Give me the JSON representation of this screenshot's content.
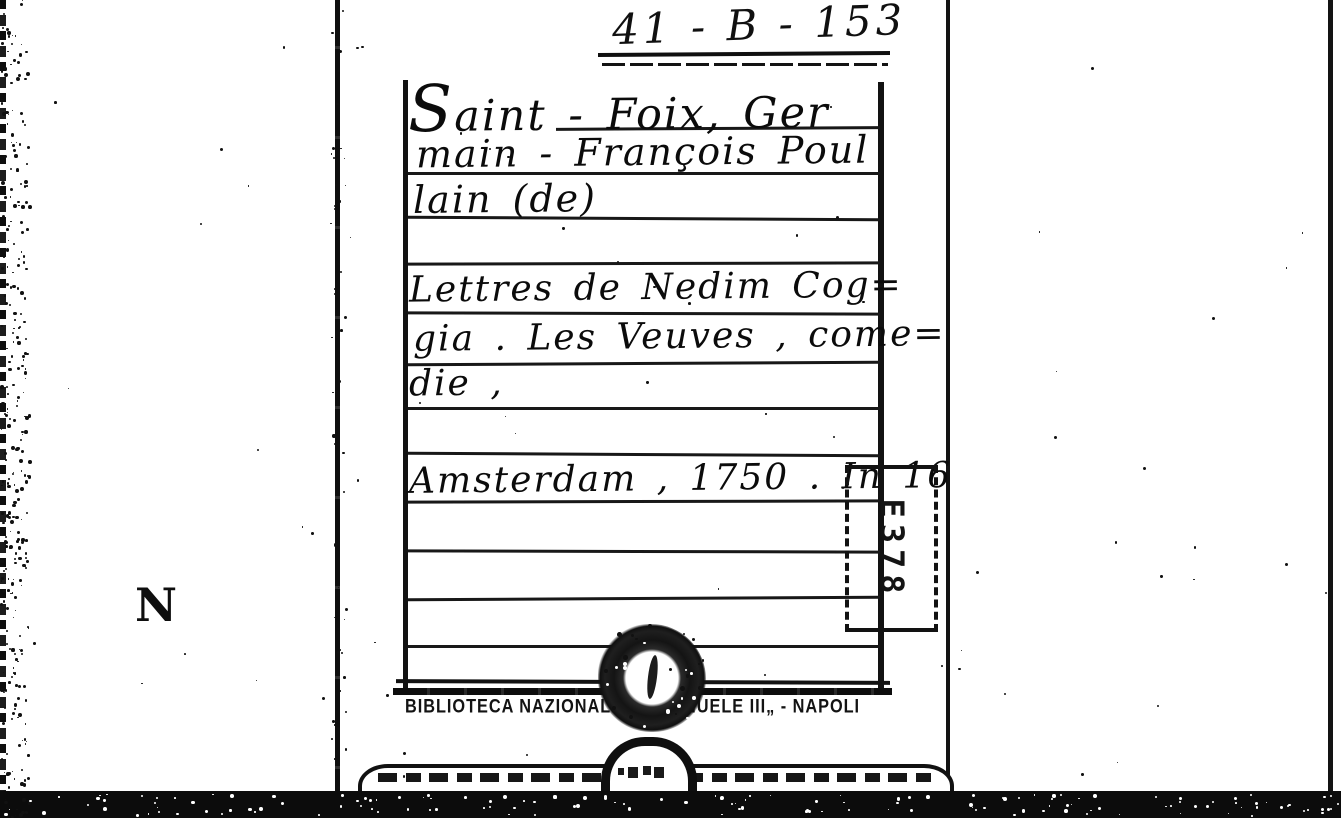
{
  "card": {
    "call_number": "41 - B - 153",
    "author_lines": [
      "Saint - Foix, Ger",
      "main - François Poul",
      "lain (de)"
    ],
    "title_lines": [
      "Lettres de Nedim Cog=",
      "gia . Les Veuves , come=",
      "die ,"
    ],
    "imprint": "Amsterdam , 1750 . In 16",
    "stamp_code": "E378",
    "library_name_left": "BIBLIOTECA NAZIONALE \"V.",
    "library_name_right": "ANUELE III„ - NAPOLI"
  },
  "drawer": {
    "guide_letter": "N"
  },
  "colors": {
    "ink": "#111111",
    "paper": "#ffffff"
  }
}
